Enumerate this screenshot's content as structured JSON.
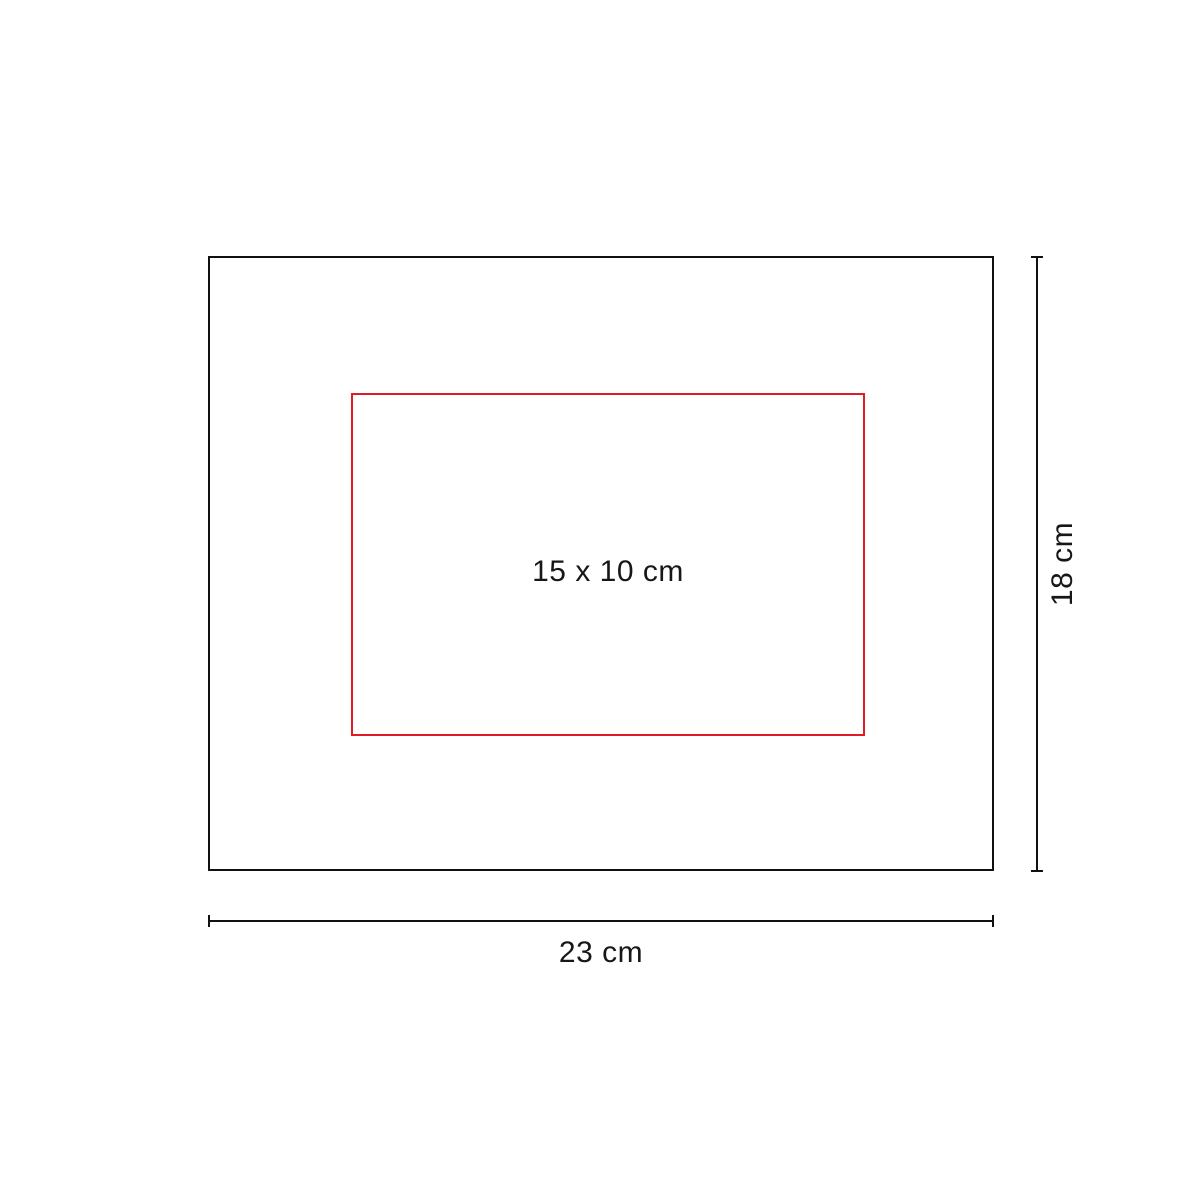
{
  "diagram": {
    "title": "product-print-area-diagram",
    "background_color": "#ffffff",
    "outline_color": "#111111",
    "product": {
      "width_cm": 23,
      "height_cm": 18
    },
    "print_area": {
      "label": "15 x 10 cm",
      "width_cm": 15,
      "height_cm": 10,
      "border_color": "#dd1c25"
    },
    "dimensions": {
      "width": {
        "label": "23 cm"
      },
      "height": {
        "label": "18 cm"
      }
    }
  }
}
